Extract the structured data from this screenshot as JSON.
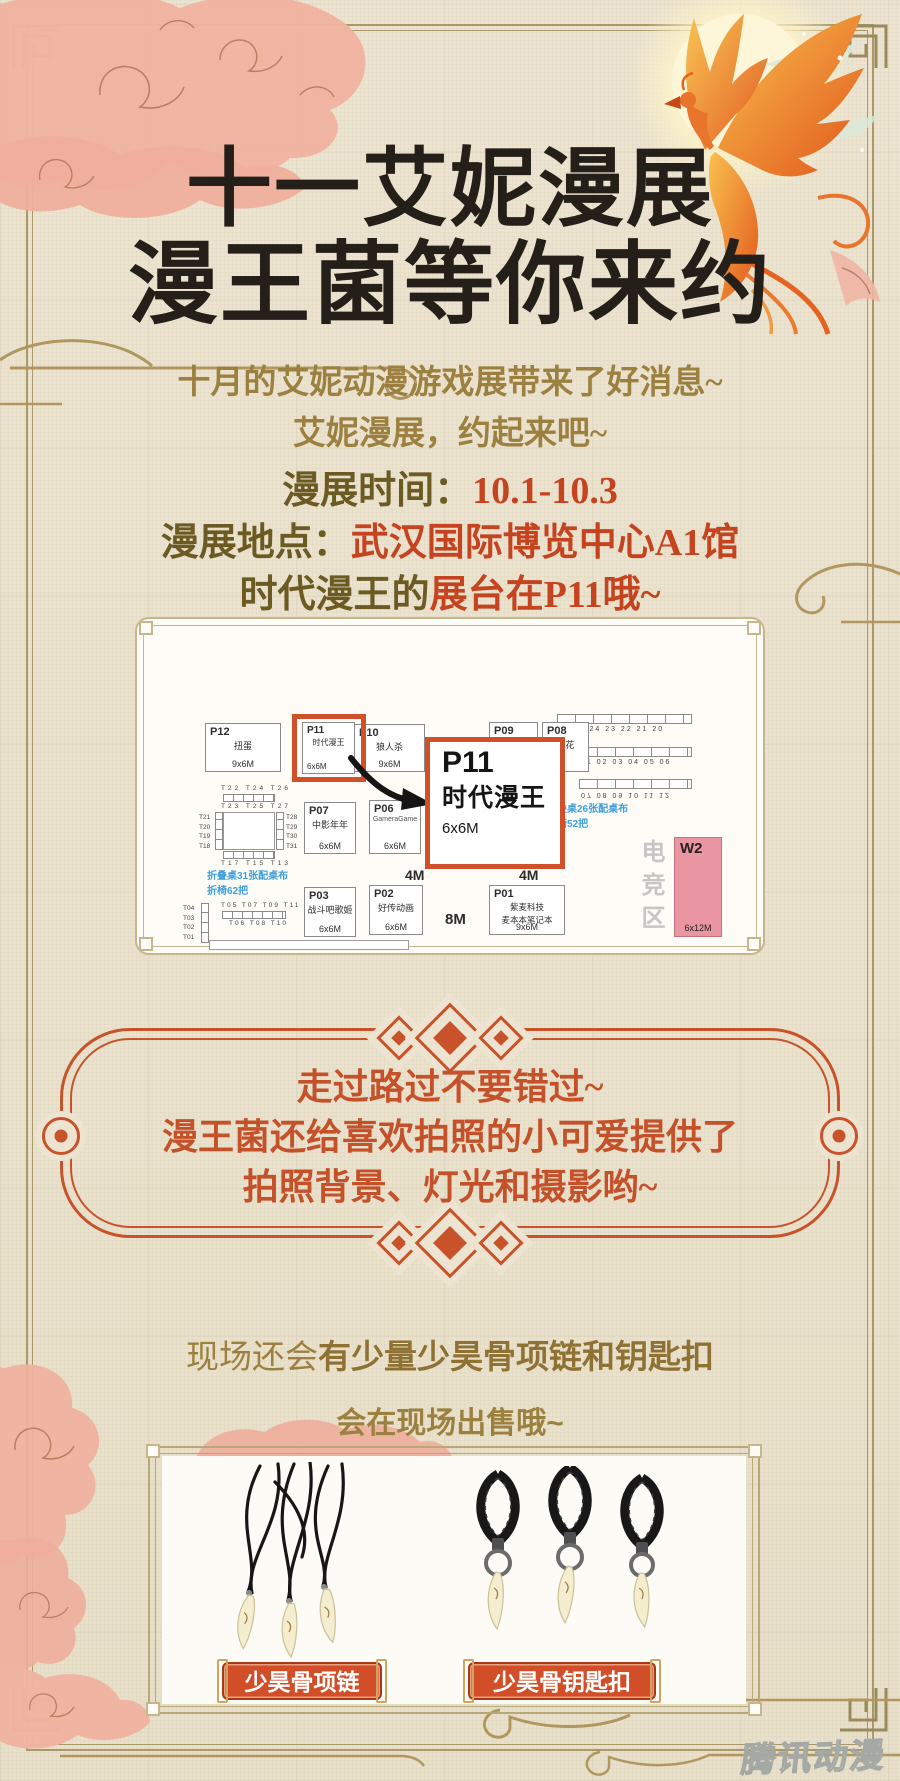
{
  "poster": {
    "title": {
      "line1": "十一艾妮漫展",
      "line2": "漫王菌等你来约"
    },
    "intro": {
      "line1": "十月的艾妮动漫游戏展带来了好消息~",
      "line2": "艾妮漫展，约起来吧~"
    },
    "info": {
      "time_label": "漫展时间：",
      "time_value": "10.1-10.3",
      "place_label": "漫展地点：",
      "place_value": "武汉国际博览中心A1馆",
      "booth_prefix": "时代漫王的",
      "booth_suffix": "展台在P11哦~"
    },
    "map": {
      "booths": [
        {
          "id": "P12",
          "name": "扭蛋",
          "size": "9x6M"
        },
        {
          "id": "P11",
          "name": "时代漫王",
          "size": "6x6M"
        },
        {
          "id": "P10",
          "name": "狼人杀",
          "size": "9x6M"
        },
        {
          "id": "P09",
          "name": "",
          "size": ""
        },
        {
          "id": "P08",
          "name": "镜花",
          "size": "M"
        },
        {
          "id": "P07",
          "name": "中影年年",
          "size": "6x6M"
        },
        {
          "id": "P06",
          "name": "GameraGame",
          "size": "6x6M"
        },
        {
          "id": "P03",
          "name": "战斗吧歌姬",
          "size": "6x6M"
        },
        {
          "id": "P02",
          "name": "好传动画",
          "size": "6x6M"
        },
        {
          "id": "P01",
          "name": "紫麦科技",
          "name2": "麦本本笔记本",
          "size": "9x6M"
        }
      ],
      "callout": {
        "id": "P11",
        "name": "时代漫王",
        "size": "6x6M"
      },
      "w2": {
        "id": "W2",
        "size": "6x12M"
      },
      "esports_zone": "电竞区",
      "aisle_4m": "4M",
      "aisle_4m_b": "4M",
      "aisle_8m": "8M",
      "notes_left": {
        "line1": "折叠桌31张配桌布",
        "line2": "折椅62把"
      },
      "notes_right": {
        "line1": "折叠桌26张配桌布",
        "line2": "折椅52把"
      },
      "right_tables": {
        "row1": "26 25 24 23 22 21 20",
        "row2": "01 02 03 04 05 06",
        "row3": "07 08 09 10 11 12"
      },
      "left_cluster": {
        "top_outer": "T22 T24 T26",
        "top_inner": "T23 T25 T27",
        "left_col": "T21\nT20\nT19\nT18",
        "right_col": "T28\nT29\nT30\nT31",
        "bottom_inner": "T17 T15 T13",
        "bottom_outer": "T16 T14 T12"
      },
      "bottom_cluster": {
        "top_row": "T05 T07 T09 T11",
        "bottom_row": "T06 T08 T10",
        "left_col": "T04\nT03\nT02\nT01"
      }
    },
    "promo_box": {
      "line1": "走过路过不要错过~",
      "line2": "漫王菌还给喜欢拍照的小可爱提供了",
      "line3": "拍照背景、灯光和摄影哟~"
    },
    "merch": {
      "line1_regular": "现场还会",
      "line1_bold": "有少量少昊骨项链和钥匙扣",
      "line2": "会在现场出售哦~",
      "products": [
        {
          "label": "少昊骨项链"
        },
        {
          "label": "少昊骨钥匙扣"
        }
      ]
    },
    "watermark": "腾讯动漫"
  },
  "colors": {
    "paper": "#ece4d1",
    "title_black": "#242019",
    "gold_text": "#9c8040",
    "dark_gold": "#6b5a22",
    "accent_red": "#c5431f",
    "accent_orange": "#c8532a",
    "map_highlight": "#d0502a",
    "w2_pink": "#ea96a2",
    "note_blue": "#3f9fdb",
    "esports_gray": "#c6c6c6",
    "label_red": "#d14e28"
  }
}
